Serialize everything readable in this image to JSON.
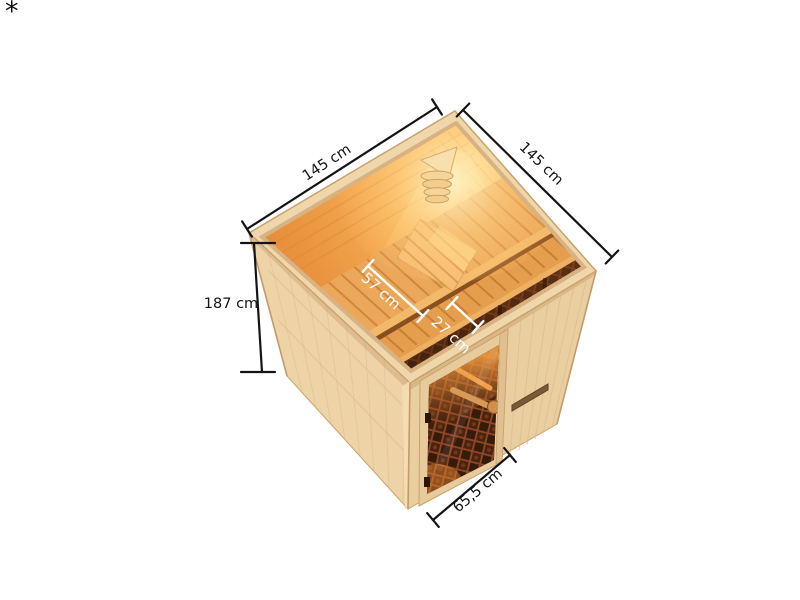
{
  "page": {
    "background": "#ffffff",
    "footnote_marker": "*"
  },
  "illustration": {
    "title": "sauna-dimension-diagram",
    "view": "isometric cutaway top view",
    "subject": "square wooden sauna cabin with corner lamp, two-tier slatted bench, headrest wedge and bronze glass door",
    "colors": {
      "wood_light": "#edd3a6",
      "wood_rim": "#f0d7ab",
      "wood_edge": "#c9a26b",
      "interior_hot": "#ffd98c",
      "interior_warm": "#f2a24b",
      "interior_deep": "#dd8232",
      "bench": "#eba75a",
      "bench_groove": "#cd8136",
      "under_bench": "#552a10",
      "glass": "#31190a",
      "glass_lattice": "#9c4c28",
      "dimension_outer": "#141414",
      "dimension_inner": "#ffffff"
    },
    "dimensions": [
      {
        "id": "outer-width-left",
        "label": "145 cm"
      },
      {
        "id": "outer-width-right",
        "label": "145 cm"
      },
      {
        "id": "wall-height",
        "label": "187 cm"
      },
      {
        "id": "bench-depth",
        "label": "57 cm"
      },
      {
        "id": "bench-step-depth",
        "label": "27 cm"
      },
      {
        "id": "door-width",
        "label": "65,5 cm"
      }
    ]
  }
}
